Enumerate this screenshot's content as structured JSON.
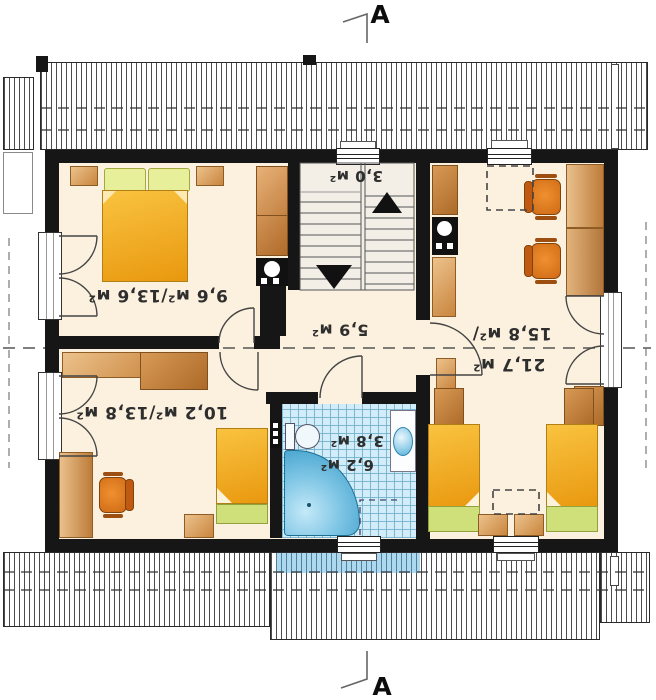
{
  "section": {
    "label": "A"
  },
  "rooms": {
    "bedroom1": "9,6 м²/13,6 м²",
    "bedroom2": "10,2 м²/13,8 м²",
    "hall": "5,9 м²",
    "closet": "3,0 м²",
    "bathroom_area_upper": "3,8 м²",
    "bathroom_area_lower": "6,2 м²",
    "living_area_line1": "15,8 м²/",
    "living_area_line2": "21,7 м²"
  },
  "colors": {
    "wall": "#161616",
    "floor": "#fcf1df",
    "bathroom_tile": "#d2ecf8",
    "furniture_wood": "#d89a56",
    "bed_orange": "#f2a93b",
    "pillow_green": "#dce98c",
    "chair_orange": "#e07820",
    "tub_blue": "#3aa5d4"
  }
}
